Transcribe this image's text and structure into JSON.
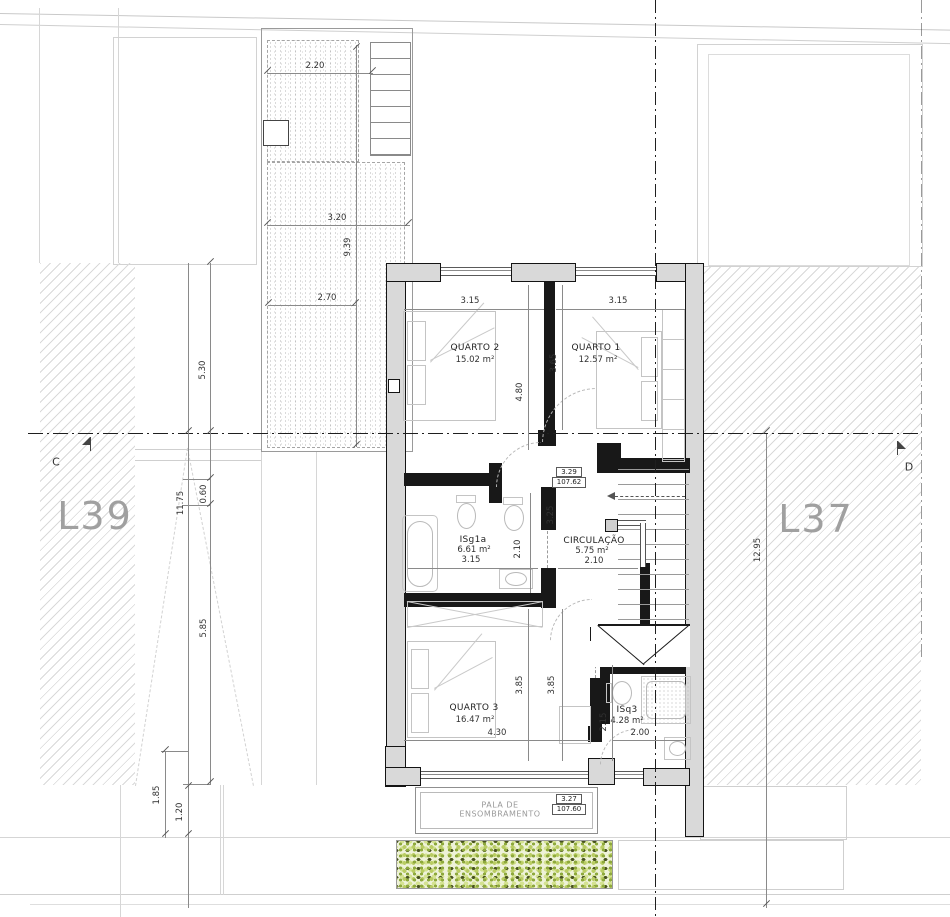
{
  "lots": {
    "left": "L39",
    "right": "L37"
  },
  "section_markers": {
    "left": "C",
    "right": "D"
  },
  "rooms": {
    "quarto2": {
      "name": "QUARTO 2",
      "area": "15.02 m²"
    },
    "quarto1": {
      "name": "QUARTO 1",
      "area": "12.57 m²"
    },
    "isg1a": {
      "name": "ISg1a",
      "area": "6.61 m²"
    },
    "circulacao": {
      "name": "CIRCULAÇÃO",
      "area": "5.75 m²"
    },
    "quarto3": {
      "name": "QUARTO 3",
      "area": "16.47 m²"
    },
    "isq3": {
      "name": "ISq3",
      "area": "4.28 m²"
    },
    "pala": {
      "line1": "PALA DE",
      "line2": "ENSOMBRAMENTO"
    }
  },
  "levels": {
    "upper": {
      "height": "3.29",
      "elevation": "107.62"
    },
    "lower": {
      "height": "3.27",
      "elevation": "107.60"
    }
  },
  "dims": {
    "d220": "2.20",
    "d320": "3.20",
    "d939": "9.39",
    "d270": "2.70",
    "q2w": "3.15",
    "q1w": "3.15",
    "q2d": "4.80",
    "q1d": "3.65",
    "hall": "3.25",
    "bathd": "2.10",
    "bathw": "3.15",
    "circw": "2.10",
    "q3da": "3.85",
    "q3db": "3.85",
    "q3w": "4.30",
    "isq3d": "2.15",
    "isq3w": "2.00",
    "s530": "5.30",
    "s1175": "11.75",
    "s060": "0.60",
    "s585": "5.85",
    "s185": "1.85",
    "s120": "1.20",
    "s1295": "12.95"
  },
  "colors": {
    "wall_fill": "#d9d9d9",
    "wall_line": "#141414",
    "hatch": "#d9d9d9",
    "hedge_light": "#b9cc63",
    "hedge_dark": "#47511f"
  }
}
